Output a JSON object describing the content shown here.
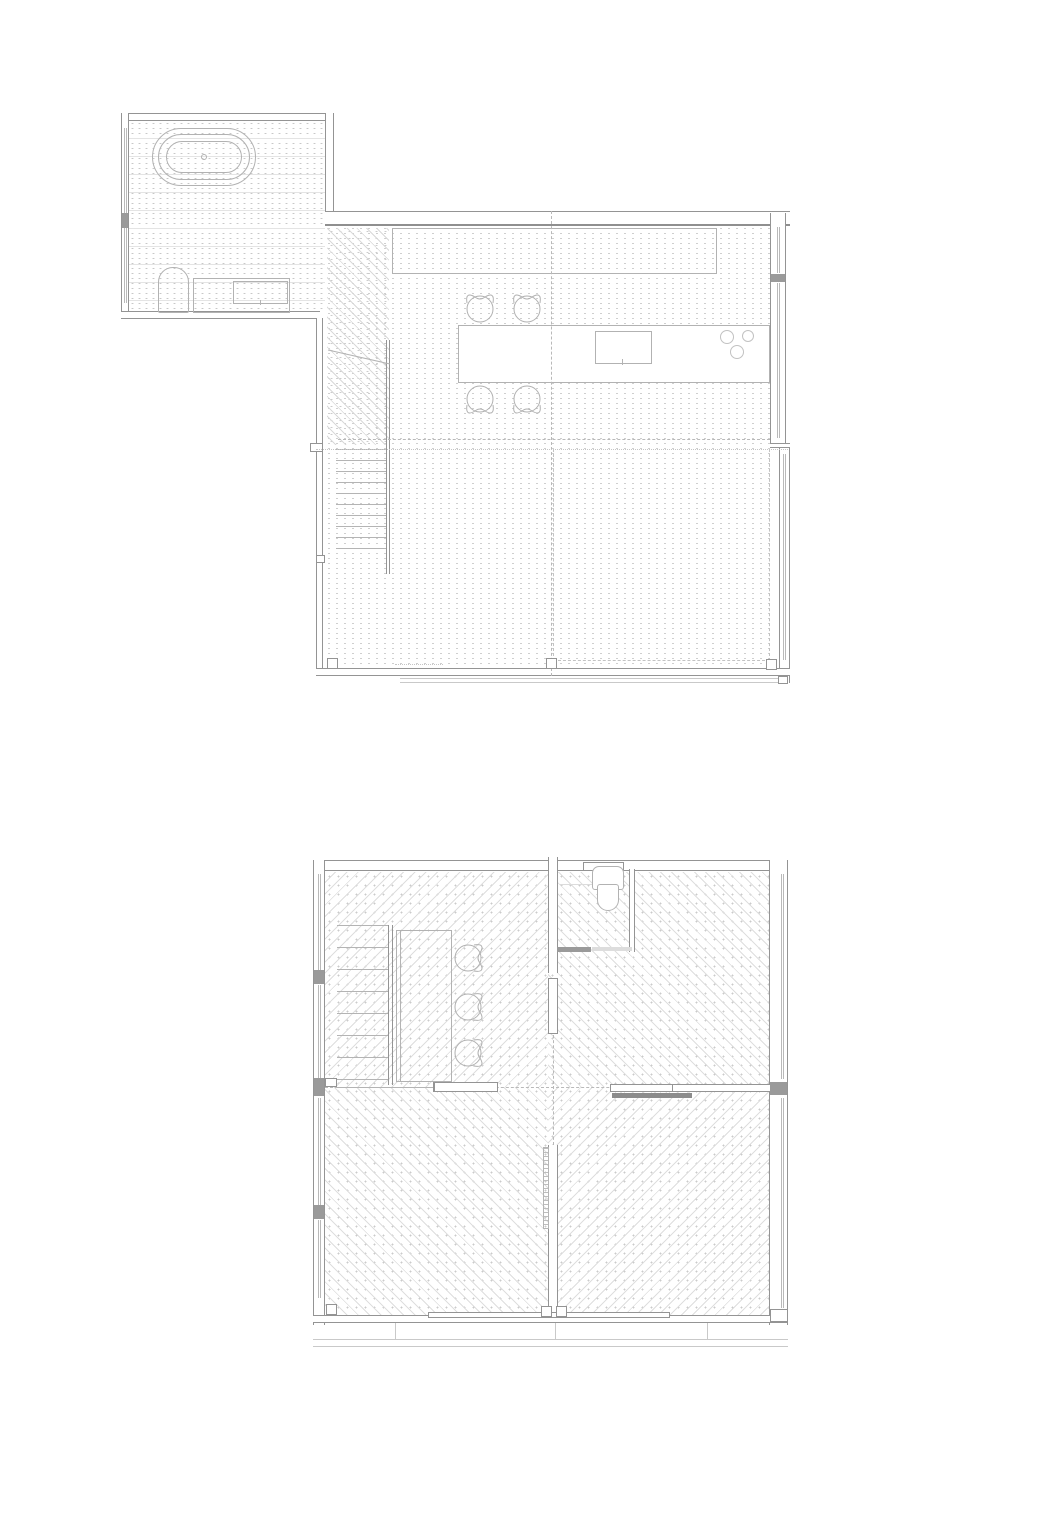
{
  "document": {
    "type": "architectural floor plan sheet",
    "visible_text": "none",
    "plan_count": 2
  },
  "palette": {
    "background": "#ffffff",
    "wall_line": "#949494",
    "fixture_line": "#b2b2b2",
    "light_line": "#c9c9c9",
    "floor_dot": "#c8c8c8",
    "overhead_dash": "#b9b9b9",
    "shade_fill": "#8c8c8c"
  },
  "plans": [
    {
      "id": "upper-floor-plan",
      "position": "top",
      "rooms": [
        {
          "name": "bathroom",
          "floor": "dotted tile grid with joint lines",
          "fixtures": [
            "freestanding-oval-bathtub",
            "toilet",
            "vanity-counter-with-basin"
          ]
        },
        {
          "name": "kitchen-dining",
          "floor": "dotted grid",
          "fixtures": [
            "wall-counter",
            "island-counter",
            "cooktop",
            "sink-bowls"
          ],
          "stool_count": 4
        },
        {
          "name": "living-area",
          "floor": "dotted grid",
          "overhead": "dashed void outline"
        }
      ],
      "stairs": {
        "tread_count": 10,
        "landing_hatch": "diagonal"
      },
      "column_count": 3,
      "glazed_walls": [
        "left",
        "right",
        "bottom-sill"
      ]
    },
    {
      "id": "lower-floor-plan",
      "position": "bottom",
      "rooms": [
        {
          "name": "hall",
          "floor": "diagonal dotted parquet",
          "fixtures": [
            "wardrobe-desk"
          ],
          "stool_count": 3
        },
        {
          "name": "wc",
          "fixtures": [
            "toilet",
            "shelf"
          ],
          "door": "threshold-opening"
        },
        {
          "name": "bedroom-left",
          "floor": "diagonal dotted parquet"
        },
        {
          "name": "bedroom-right",
          "floor": "diagonal dotted parquet",
          "door": "pocket-sliding-leaf"
        }
      ],
      "stairs": {
        "tread_count": 8
      },
      "column_count": 3,
      "sliding_panels": 3,
      "terrace": "deck edge lines below plan",
      "floor_pattern_layout": "four quadrants mirrored about centre axes"
    }
  ],
  "render": {
    "treads": [
      {
        "plan": "top",
        "name": "stair-tread",
        "x": 336,
        "w": 50,
        "y0": 449,
        "dy": 11,
        "count": 10
      },
      {
        "plan": "bottom",
        "name": "stair-tread",
        "x": 337,
        "w": 51,
        "y0": 925,
        "dy": 22,
        "count": 8
      }
    ],
    "stools": [
      {
        "plan": "top",
        "name": "stool",
        "cx": 480,
        "cy": 307,
        "rot": 0
      },
      {
        "plan": "top",
        "name": "stool",
        "cx": 527,
        "cy": 307,
        "rot": 0
      },
      {
        "plan": "top",
        "name": "stool",
        "cx": 480,
        "cy": 401,
        "rot": 180
      },
      {
        "plan": "top",
        "name": "stool",
        "cx": 527,
        "cy": 401,
        "rot": 180
      },
      {
        "plan": "bottom",
        "name": "stool",
        "cx": 470,
        "cy": 958,
        "rot": 90
      },
      {
        "plan": "bottom",
        "name": "stool",
        "cx": 470,
        "cy": 1007,
        "rot": 90
      },
      {
        "plan": "bottom",
        "name": "stool",
        "cx": 470,
        "cy": 1053,
        "rot": 90
      }
    ],
    "sink_bowls": [
      {
        "plan": "top",
        "name": "sink-bowl",
        "x": 720,
        "y": 330,
        "d": 14
      },
      {
        "plan": "top",
        "name": "sink-bowl",
        "x": 742,
        "y": 330,
        "d": 12
      },
      {
        "plan": "top",
        "name": "sink-bowl",
        "x": 730,
        "y": 345,
        "d": 14
      }
    ],
    "columns": [
      {
        "plan": "top",
        "name": "column",
        "x": 327,
        "y": 658
      },
      {
        "plan": "top",
        "name": "column",
        "x": 546,
        "y": 658
      },
      {
        "plan": "top",
        "name": "column",
        "x": 766,
        "y": 659
      },
      {
        "plan": "bottom",
        "name": "column",
        "x": 326,
        "y": 1304
      },
      {
        "plan": "bottom",
        "name": "column",
        "x": 541,
        "y": 1306
      },
      {
        "plan": "bottom",
        "name": "column",
        "x": 556,
        "y": 1306
      }
    ],
    "stool_glyph": {
      "circle": {
        "cx": 18,
        "cy": 20,
        "r": 13
      },
      "back_path": "M5 14 Q3 2 13 8 Q18 12 23 8 Q33 2 31 14",
      "stroke": "#b0b0b0"
    }
  }
}
